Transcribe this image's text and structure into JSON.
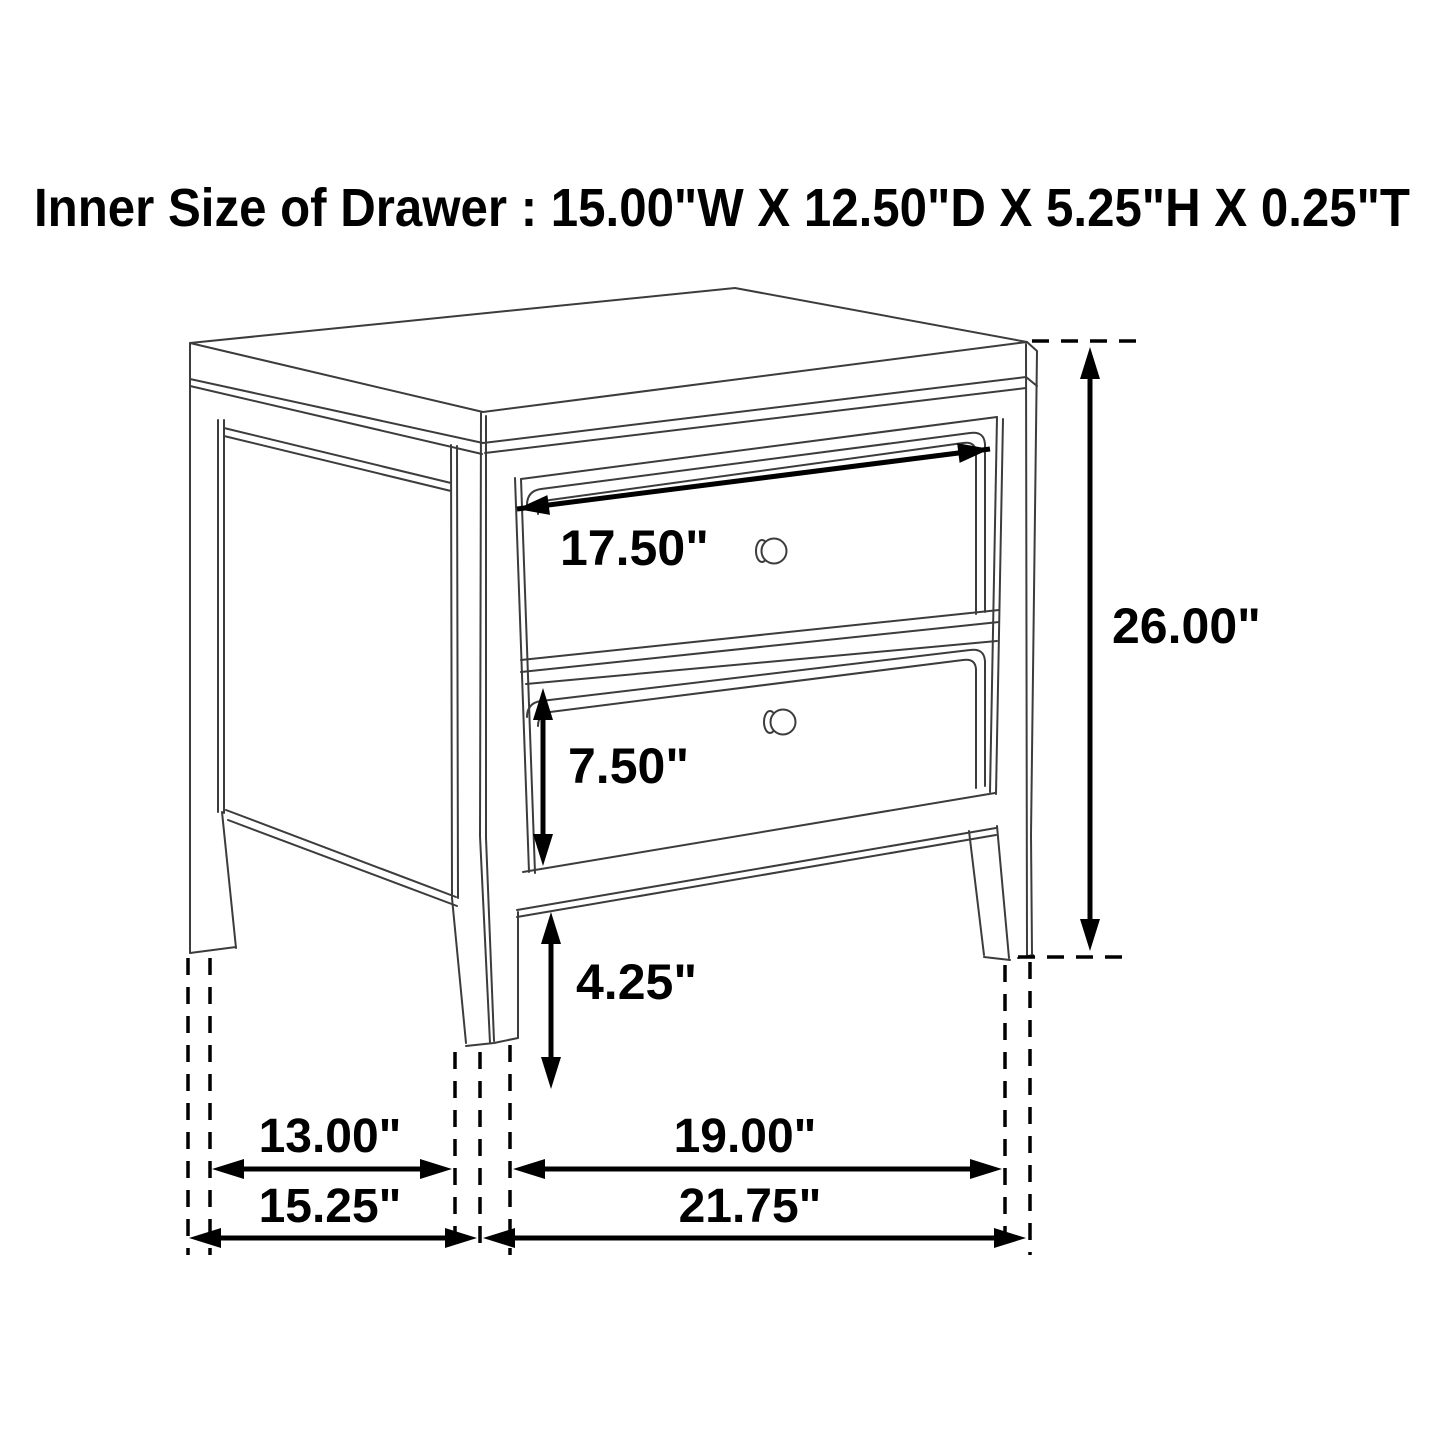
{
  "title": "Inner Size of Drawer : 15.00\"W X 12.50\"D X 5.25\"H X 0.25\"T",
  "inner_drawer_size": {
    "width": "15.00\"",
    "depth": "12.50\"",
    "height": "5.25\"",
    "thickness": "0.25\""
  },
  "figure": {
    "item": "Two-drawer nightstand dimension line drawing, three-quarter perspective view",
    "drawer_count": 2,
    "dimensions": {
      "drawer_width": "17.50\"",
      "overall_height": "26.00\"",
      "drawer_front_height": "7.50\"",
      "bottom_clearance": "4.25\"",
      "side_leg_spacing": "13.00\"",
      "front_leg_spacing": "19.00\"",
      "overall_depth": "15.25\"",
      "overall_width": "21.75\""
    },
    "colors": {
      "background": "#ffffff",
      "drawing_line": "#3c3c3c",
      "dimension_ink": "#000000"
    }
  }
}
